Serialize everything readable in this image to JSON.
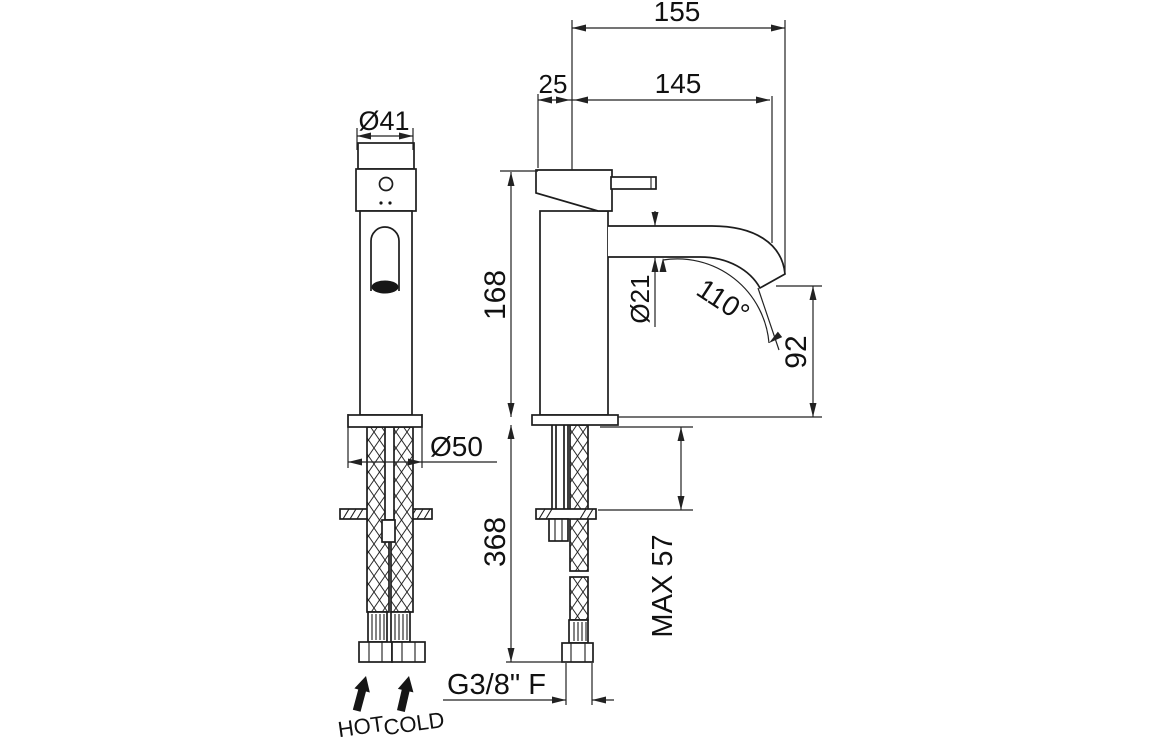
{
  "drawing": {
    "type": "technical-dimension-drawing",
    "views": {
      "front_view": "tap front elevation",
      "side_view": "tap side elevation"
    },
    "labels": {
      "overall_reach": "155",
      "axis_offset": "25",
      "spout_reach": "145",
      "handle_dia": "Ø41",
      "body_height": "168",
      "spout_dia": "Ø21",
      "spout_angle": "110°",
      "outlet_height": "92",
      "base_dia": "Ø50",
      "install_depth": "368",
      "max_thickness": "MAX 57",
      "connection": "G3/8\" F",
      "hot": "HOT",
      "cold": "COLD"
    },
    "colors": {
      "line": "#1d1d1d",
      "background": "#ffffff"
    }
  }
}
